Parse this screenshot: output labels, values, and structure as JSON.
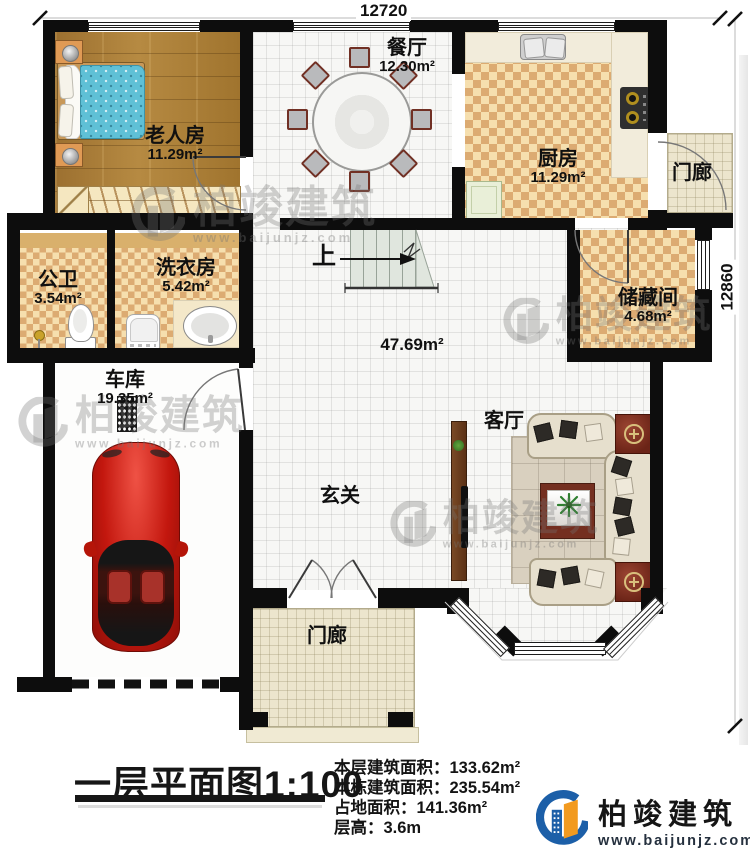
{
  "dimensions": {
    "top": "12720",
    "right": "12860"
  },
  "rooms": {
    "bedroom": {
      "name": "老人房",
      "area": "11.29m²"
    },
    "dining": {
      "name": "餐厅",
      "area": "12.30m²"
    },
    "kitchen": {
      "name": "厨房",
      "area": "11.29m²"
    },
    "porch_right": {
      "name": "门廊"
    },
    "bathroom": {
      "name": "公卫",
      "area": "3.54m²"
    },
    "laundry": {
      "name": "洗衣房",
      "area": "5.42m²"
    },
    "storage": {
      "name": "储藏间",
      "area": "4.68m²"
    },
    "garage": {
      "name": "车库",
      "area": "19.35m²"
    },
    "hall": {
      "name": "玄关"
    },
    "open_area": {
      "area": "47.69m²"
    },
    "living": {
      "name": "客厅"
    },
    "porch_front": {
      "name": "门廊"
    },
    "stairs_label": "上"
  },
  "title": {
    "text": "一层平面图",
    "scale": "1:100"
  },
  "info": {
    "line1_label": "本层建筑面积：",
    "line1_value": "133.62m²",
    "line2_label": "本栋建筑面积：",
    "line2_value": "235.54m²",
    "line3_label": "占地面积：",
    "line3_value": "141.36m²",
    "line4_label": "层高：",
    "line4_value": "3.6m"
  },
  "logo": {
    "name": "柏竣建筑",
    "url": "www.baijunjz.com"
  },
  "watermark": {
    "name": "柏竣建筑",
    "url": "www.baijunjz.com"
  },
  "colors": {
    "wall": "#0d0d0d",
    "wood_floor": "#a87c36",
    "check_light": "#f6dfae",
    "check_dark": "#dcab72",
    "logo_blue": "#1c5fa8",
    "logo_orange": "#f29a1f",
    "car_red": "#c3170e"
  }
}
